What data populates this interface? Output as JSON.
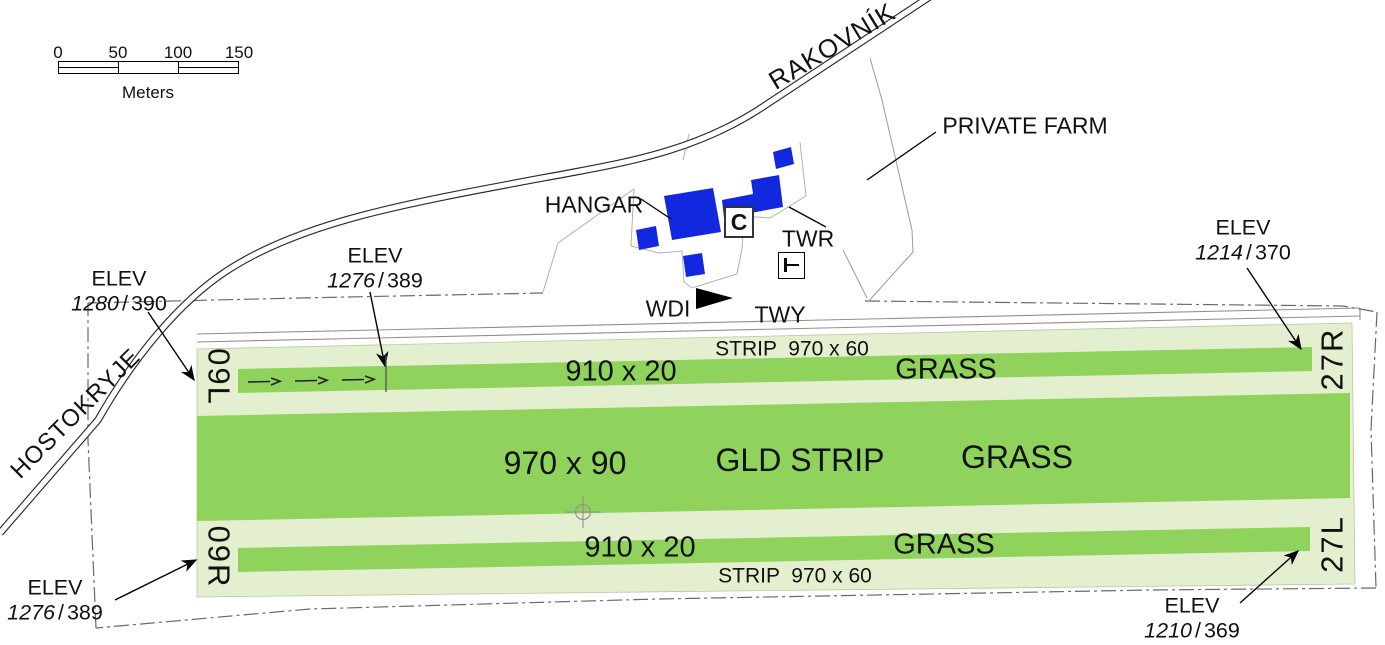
{
  "scale_bar": {
    "ticks": [
      "0",
      "50",
      "100",
      "150"
    ],
    "unit": "Meters"
  },
  "roads": {
    "rakovnik": "RAKOVNÍK",
    "hostokryje": "HOSTOKRYJE"
  },
  "site": {
    "private_farm": "PRIVATE FARM",
    "hangar": "HANGAR",
    "twr": "TWR",
    "twy": "TWY",
    "wdi": "WDI",
    "signal_area": "C"
  },
  "strips": {
    "top": {
      "runway_dims": "910 x 20",
      "surface": "GRASS",
      "strip_label": "STRIP  970 x 60",
      "designator_west": "09L",
      "designator_east": "27R"
    },
    "middle": {
      "dims": "970 x 90",
      "name": "GLD STRIP",
      "surface": "GRASS"
    },
    "bottom": {
      "runway_dims": "910 x 20",
      "surface": "GRASS",
      "strip_label": "STRIP  970 x 60",
      "designator_west": "09R",
      "designator_east": "27L"
    }
  },
  "elevations": {
    "west_road": {
      "label": "ELEV",
      "ft": "1280",
      "sep": "/",
      "m": "390"
    },
    "thr_09l": {
      "label": "ELEV",
      "ft": "1276",
      "sep": "/",
      "m": "389"
    },
    "thr_09r": {
      "label": "ELEV",
      "ft": "1276",
      "sep": "/",
      "m": "389"
    },
    "thr_27r": {
      "label": "ELEV",
      "ft": "1214",
      "sep": "/",
      "m": "370"
    },
    "thr_27l": {
      "label": "ELEV",
      "ft": "1210",
      "sep": "/",
      "m": "369"
    }
  },
  "colors": {
    "runway_green": "#8FD25C",
    "strip_green": "#E3EFCF",
    "building_blue": "#1228DE",
    "boundary_gray": "#6a6a6a"
  }
}
